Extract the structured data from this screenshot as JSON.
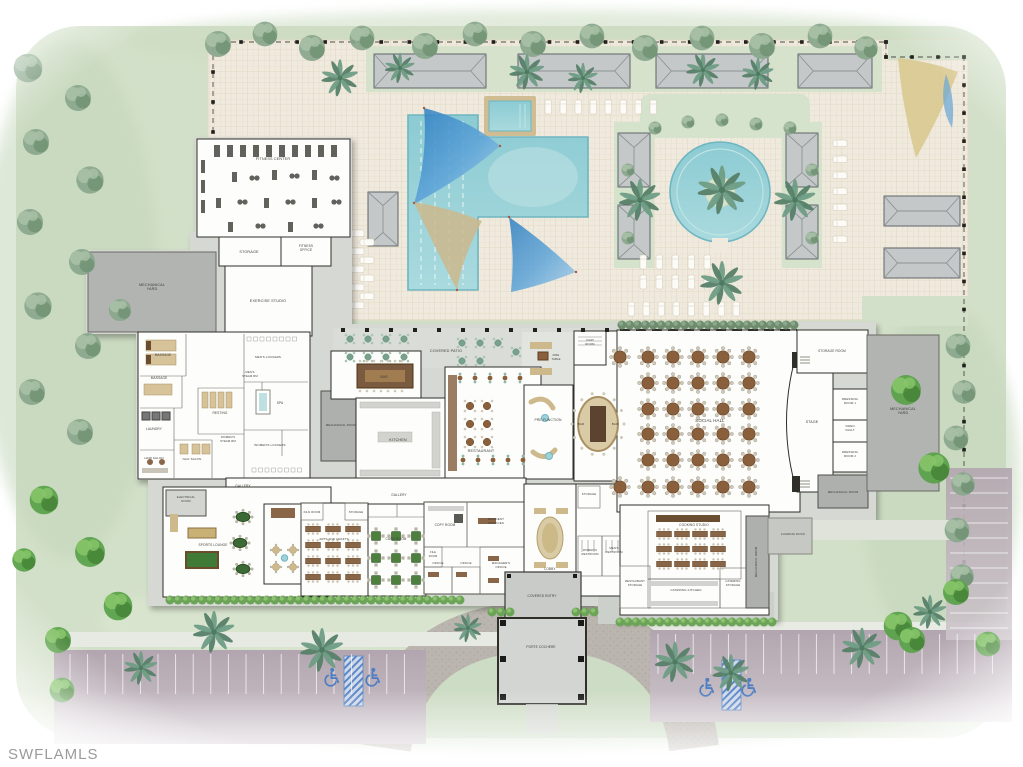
{
  "watermark": "SWFLAMLS",
  "colors": {
    "lawn": "#d3e0c9",
    "deck": "#f0eade",
    "pool": "#9fd3d9",
    "pool_edge": "#6fb6c0",
    "sail_blue": "#3d8cc9",
    "sail_tan": "#cdb98c",
    "wall": "#2f2e29",
    "room": "#fdfdfb",
    "terrace": "#d6d8d4",
    "mech": "#b2b4b2",
    "parking": "#b2a5af",
    "drive": "#bab5ae",
    "handicap": "#4f7fc2",
    "tree_bright": "#5ba24c",
    "tree_sage": "#8aa88d",
    "palm": "#6f9d85",
    "furniture_wood": "#8a5f3c",
    "table_green": "#4d7f3e",
    "tan": "#cdb98c",
    "watermark": "#9b9b9b"
  },
  "plan": {
    "title": "Clubhouse amenity site plan",
    "labels": [
      {
        "id": "fitness-center",
        "t": "FITNESS CENTER",
        "x": 273,
        "y": 160
      },
      {
        "id": "storage-fitness",
        "t": "STORAGE",
        "x": 249,
        "y": 253
      },
      {
        "id": "fitness-office",
        "lines": [
          "FITNESS",
          "OFFICE"
        ],
        "x": 306,
        "y": 249,
        "size": 3.2
      },
      {
        "id": "exercise-studio",
        "t": "EXERCISE STUDIO",
        "x": 268,
        "y": 302
      },
      {
        "id": "mechanical-yard-west",
        "lines": [
          "MECHANICAL",
          "YARD"
        ],
        "x": 152,
        "y": 288
      },
      {
        "id": "massage-1",
        "t": "MASSAGE",
        "x": 163,
        "y": 356,
        "size": 3.2
      },
      {
        "id": "massage-2",
        "t": "MASSAGE",
        "x": 159,
        "y": 379,
        "size": 3.2
      },
      {
        "id": "laundry",
        "t": "LAUNDRY",
        "x": 154,
        "y": 430,
        "size": 3.2
      },
      {
        "id": "hair-salon",
        "t": "HAIR SALON",
        "x": 154,
        "y": 459,
        "size": 3
      },
      {
        "id": "nail-salon",
        "t": "NAIL SALON",
        "x": 192,
        "y": 460,
        "size": 3
      },
      {
        "id": "resting",
        "t": "RESTING",
        "x": 220,
        "y": 414,
        "size": 3.2
      },
      {
        "id": "womens-steam",
        "lines": [
          "WOMEN'S",
          "STEAM RM"
        ],
        "x": 228,
        "y": 440,
        "size": 2.8
      },
      {
        "id": "womens-lockers",
        "t": "WOMEN'S LOCKERS",
        "x": 270,
        "y": 446,
        "size": 3
      },
      {
        "id": "mens-lockers",
        "t": "MEN'S LOCKERS",
        "x": 268,
        "y": 358,
        "size": 3
      },
      {
        "id": "mens-steam",
        "lines": [
          "MEN'S",
          "STEAM RM"
        ],
        "x": 250,
        "y": 375,
        "size": 2.8
      },
      {
        "id": "spa",
        "t": "SPA",
        "x": 280,
        "y": 404,
        "size": 3.2
      },
      {
        "id": "mechanical-room-center",
        "t": "MECHANICAL ROOM",
        "x": 341,
        "y": 426,
        "size": 2.9
      },
      {
        "id": "bar-main",
        "t": "BAR",
        "x": 384,
        "y": 378,
        "size": 3.4
      },
      {
        "id": "covered-patio",
        "t": "COVERED PATIO",
        "x": 446,
        "y": 352
      },
      {
        "id": "kitchen",
        "t": "KITCHEN",
        "x": 398,
        "y": 441
      },
      {
        "id": "restaurant",
        "t": "RESTAURANT",
        "x": 481,
        "y": 452
      },
      {
        "id": "fire-table",
        "lines": [
          "FIRE",
          "TABLE"
        ],
        "x": 556,
        "y": 358,
        "size": 2.8
      },
      {
        "id": "coat-room",
        "lines": [
          "COAT",
          "ROOM"
        ],
        "x": 590,
        "y": 343,
        "size": 2.8
      },
      {
        "id": "pre-function",
        "t": "PRE-FUNCTION",
        "x": 548,
        "y": 421,
        "size": 3.4
      },
      {
        "id": "bar-oval-left",
        "t": "BAR",
        "x": 581,
        "y": 425,
        "size": 3
      },
      {
        "id": "bar-oval-right",
        "t": "BAR",
        "x": 615,
        "y": 425,
        "size": 3
      },
      {
        "id": "social-hall",
        "t": "SOCIAL HALL",
        "x": 710,
        "y": 422,
        "size": 4.4
      },
      {
        "id": "stage",
        "t": "STAGE",
        "x": 812,
        "y": 423,
        "size": 3.6
      },
      {
        "id": "storage-room-stage",
        "t": "STORAGE ROOM",
        "x": 832,
        "y": 352,
        "size": 3.2
      },
      {
        "id": "dressing-room-1",
        "lines": [
          "DRESSING",
          "ROOM 1"
        ],
        "x": 850,
        "y": 402,
        "size": 2.9
      },
      {
        "id": "video-vault",
        "lines": [
          "VIDEO",
          "VAULT"
        ],
        "x": 850,
        "y": 429,
        "size": 2.9
      },
      {
        "id": "dressing-room-2",
        "lines": [
          "DRESSING",
          "ROOM 2"
        ],
        "x": 850,
        "y": 455,
        "size": 2.9
      },
      {
        "id": "mechanical-room-stage",
        "t": "MECHANICAL ROOM",
        "x": 843,
        "y": 493,
        "size": 2.9
      },
      {
        "id": "mechanical-yard-east",
        "lines": [
          "MECHANICAL",
          "YARD"
        ],
        "x": 903,
        "y": 412
      },
      {
        "id": "gallery-west",
        "t": "GALLERY",
        "x": 243,
        "y": 487,
        "size": 3.2
      },
      {
        "id": "gallery-center",
        "t": "GALLERY",
        "x": 399,
        "y": 496,
        "size": 3.2
      },
      {
        "id": "electrical-room",
        "lines": [
          "ELECTRICAL",
          "ROOM"
        ],
        "x": 186,
        "y": 500,
        "size": 2.8
      },
      {
        "id": "sports-lounge",
        "t": "SPORTS LOUNGE",
        "x": 213,
        "y": 546,
        "size": 3.2
      },
      {
        "id": "kiln-room",
        "t": "KILN ROOM",
        "x": 312,
        "y": 513,
        "size": 2.8
      },
      {
        "id": "storage-arts",
        "t": "STORAGE",
        "x": 356,
        "y": 513,
        "size": 2.8
      },
      {
        "id": "arts-and-crafts",
        "t": "ARTS AND CRAFTS",
        "x": 334,
        "y": 540,
        "size": 3
      },
      {
        "id": "card-room",
        "t": "CARD ROOM",
        "x": 396,
        "y": 540,
        "size": 3.2
      },
      {
        "id": "copy-room",
        "t": "COPY ROOM",
        "x": 445,
        "y": 526,
        "size": 3.2
      },
      {
        "id": "resident-services",
        "lines": [
          "RESIDENT",
          "SERVICES"
        ],
        "x": 496,
        "y": 522,
        "size": 3
      },
      {
        "id": "file-room",
        "lines": [
          "FILE",
          "ROOM"
        ],
        "x": 433,
        "y": 555,
        "size": 2.6
      },
      {
        "id": "office-1",
        "t": "OFFICE",
        "x": 438,
        "y": 564,
        "size": 2.9
      },
      {
        "id": "office-2",
        "t": "OFFICE",
        "x": 466,
        "y": 564,
        "size": 2.9
      },
      {
        "id": "managers-office",
        "lines": [
          "MANAGER'S",
          "OFFICE"
        ],
        "x": 501,
        "y": 566,
        "size": 2.9
      },
      {
        "id": "lobby",
        "t": "LOBBY",
        "x": 550,
        "y": 570,
        "size": 3.2
      },
      {
        "id": "covered-entry",
        "t": "COVERED ENTRY",
        "x": 542,
        "y": 597,
        "size": 3.2
      },
      {
        "id": "porte-cochere",
        "t": "PORTE COCHERE",
        "x": 541,
        "y": 648,
        "size": 3.2
      },
      {
        "id": "storage-lobby",
        "t": "STORAGE",
        "x": 589,
        "y": 495,
        "size": 2.8
      },
      {
        "id": "womens-restroom",
        "lines": [
          "WOMEN'S",
          "RESTROOM"
        ],
        "x": 590,
        "y": 553,
        "size": 2.8
      },
      {
        "id": "mens-restroom",
        "lines": [
          "MEN'S",
          "RESTROOM"
        ],
        "x": 614,
        "y": 551,
        "size": 2.8
      },
      {
        "id": "restaurant-storage",
        "lines": [
          "RESTAURANT",
          "STORAGE"
        ],
        "x": 635,
        "y": 584,
        "size": 2.8
      },
      {
        "id": "cooking-studio",
        "t": "COOKING STUDIO",
        "x": 694,
        "y": 526,
        "size": 3.2
      },
      {
        "id": "catering-kitchen",
        "t": "CATERING KITCHEN",
        "x": 686,
        "y": 591,
        "size": 3
      },
      {
        "id": "catering-storage",
        "lines": [
          "CATERING",
          "STORAGE"
        ],
        "x": 733,
        "y": 584,
        "size": 2.8
      },
      {
        "id": "mechanical-room-east",
        "t": "MECHANICAL ROOM",
        "x": 757,
        "y": 562,
        "rot": -90,
        "size": 2.9
      },
      {
        "id": "loading-dock",
        "t": "LOADING DOCK",
        "x": 793,
        "y": 535,
        "size": 3
      }
    ]
  }
}
